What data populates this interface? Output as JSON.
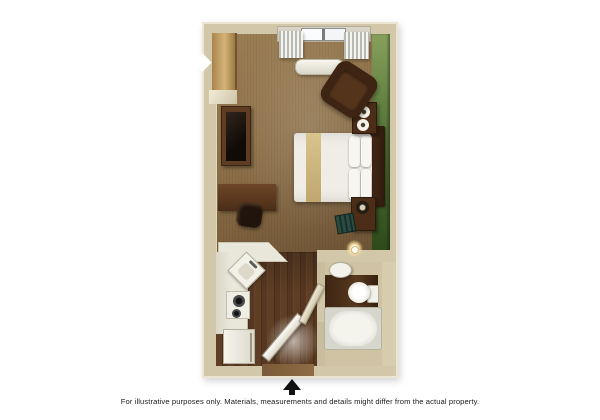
{
  "scene": {
    "type": "3d-floor-plan",
    "unit": "studio-suite",
    "rooms": [
      "bedroom-living",
      "kitchen",
      "bathroom",
      "entry"
    ],
    "furniture_icons": [
      "window-with-curtains-icon",
      "ac-unit-icon",
      "closet-icon",
      "tv-cabinet-icon",
      "wall-sconce-icon",
      "desk-icon",
      "desk-chair-icon",
      "bed-icon",
      "headboard-icon",
      "pillow-icon",
      "nightstand-icon",
      "cup-icon",
      "armchair-icon",
      "luggage-rack-icon",
      "kitchen-counter-icon",
      "corner-sink-icon",
      "cooktop-icon",
      "refrigerator-icon",
      "entry-door-icon",
      "bathroom-sink-icon",
      "toilet-icon",
      "bathtub-icon",
      "bathroom-door-icon"
    ]
  },
  "footer": {
    "north_arrow_icon": "north-arrow",
    "disclaimer": "For illustrative purposes only.  Materials, measurements and details might differ from the actual property."
  },
  "colors": {
    "wall": "#d2c8a9",
    "wall_edge": "#ece5d2",
    "carpet": "#8a6d46",
    "carpet_light": "#9c7f54",
    "carpet_dark": "#6e5436",
    "wood": "#64452a",
    "wood_light": "#5e3e24",
    "green_top": "#87a05c",
    "green_mid": "#557436",
    "green_bottom": "#2c4a1a",
    "furniture_mid": "#5f3d22",
    "bedding": "#efede5",
    "runner": "#d9c48d",
    "counter": "#e9e7da",
    "fixture": "#f3f2ea",
    "tub": "#d7d6cd",
    "text": "#1c1c1c"
  }
}
